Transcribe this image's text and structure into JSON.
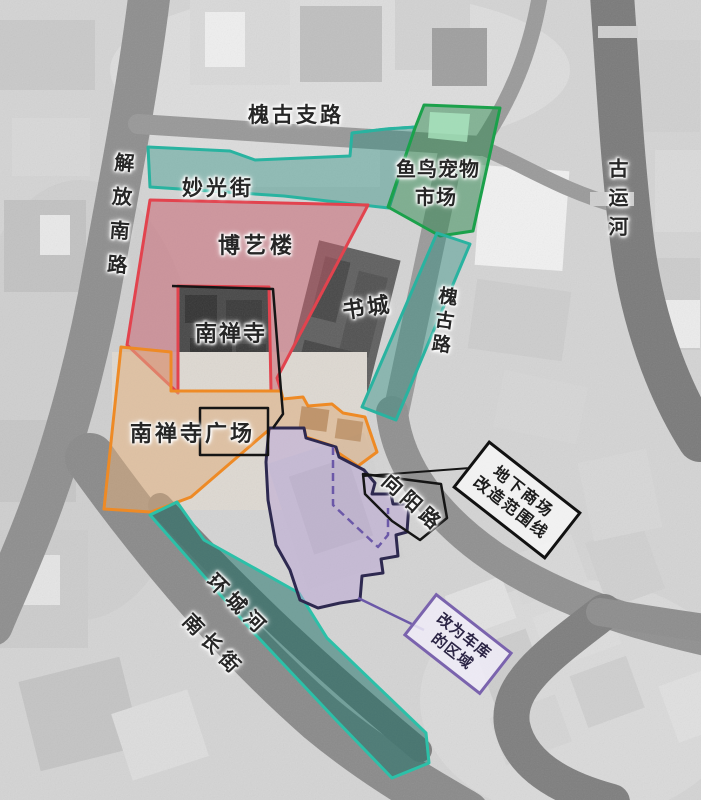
{
  "map": {
    "type": "aerial-annotation-map",
    "base": "grayscale satellite photo"
  },
  "labels": {
    "huaigu_zhilu": "槐古支路",
    "jiefang_nanlu": "解放南路",
    "miaoguang_jie": "妙光街",
    "yuniao_line1": "鱼鸟宠物",
    "yuniao_line2": "市场",
    "boyilou": "博艺楼",
    "nanchansi": "南禅寺",
    "shucheng": "书城",
    "huaigu_lu": "槐古路",
    "gu_yunhe": "古运河",
    "nanchansi_guangchang": "南禅寺广场",
    "xiangyang_lu": "向阳路",
    "huancheng_he": "环城河",
    "nanchang_jie": "南长街"
  },
  "callouts": {
    "underground": {
      "line1": "地下商场",
      "line2": "改造范围线",
      "border": "#111111"
    },
    "garage": {
      "line1": "改为车库",
      "line2": "的区域",
      "border": "#7a63ad"
    }
  },
  "regions": {
    "miaoguang_street_zone": {
      "name": "妙光街",
      "stroke": "#29b3a0",
      "fill": "rgba(34,140,126,0.40)"
    },
    "huaigu_road_strip": {
      "name": "槐古路",
      "stroke": "#29b3a0",
      "fill": "rgba(34,140,126,0.40)"
    },
    "huancheng_river_zone": {
      "name": "环城河",
      "stroke": "#2cc0a8",
      "fill": "rgba(22,110,100,0.50)"
    },
    "fish_bird_market": {
      "name": "鱼鸟宠物市场",
      "stroke": "#1ba14b",
      "fill": "rgba(40,135,75,0.48)"
    },
    "boyilou_block": {
      "name": "博艺楼",
      "stroke": "#e2434e",
      "fill": "rgba(200,92,106,0.50)"
    },
    "nanchansi_plaza": {
      "name": "南禅寺广场",
      "stroke": "#ee8a25",
      "fill": "rgba(222,175,128,0.55)"
    },
    "underground_mall_area": {
      "name": "地下商场改造区",
      "stroke": "#2e2950",
      "fill": "rgba(187,168,214,0.55)"
    }
  },
  "line_colors": {
    "boundary_black": "#151515",
    "dashed_purple": "#6b58a8"
  }
}
